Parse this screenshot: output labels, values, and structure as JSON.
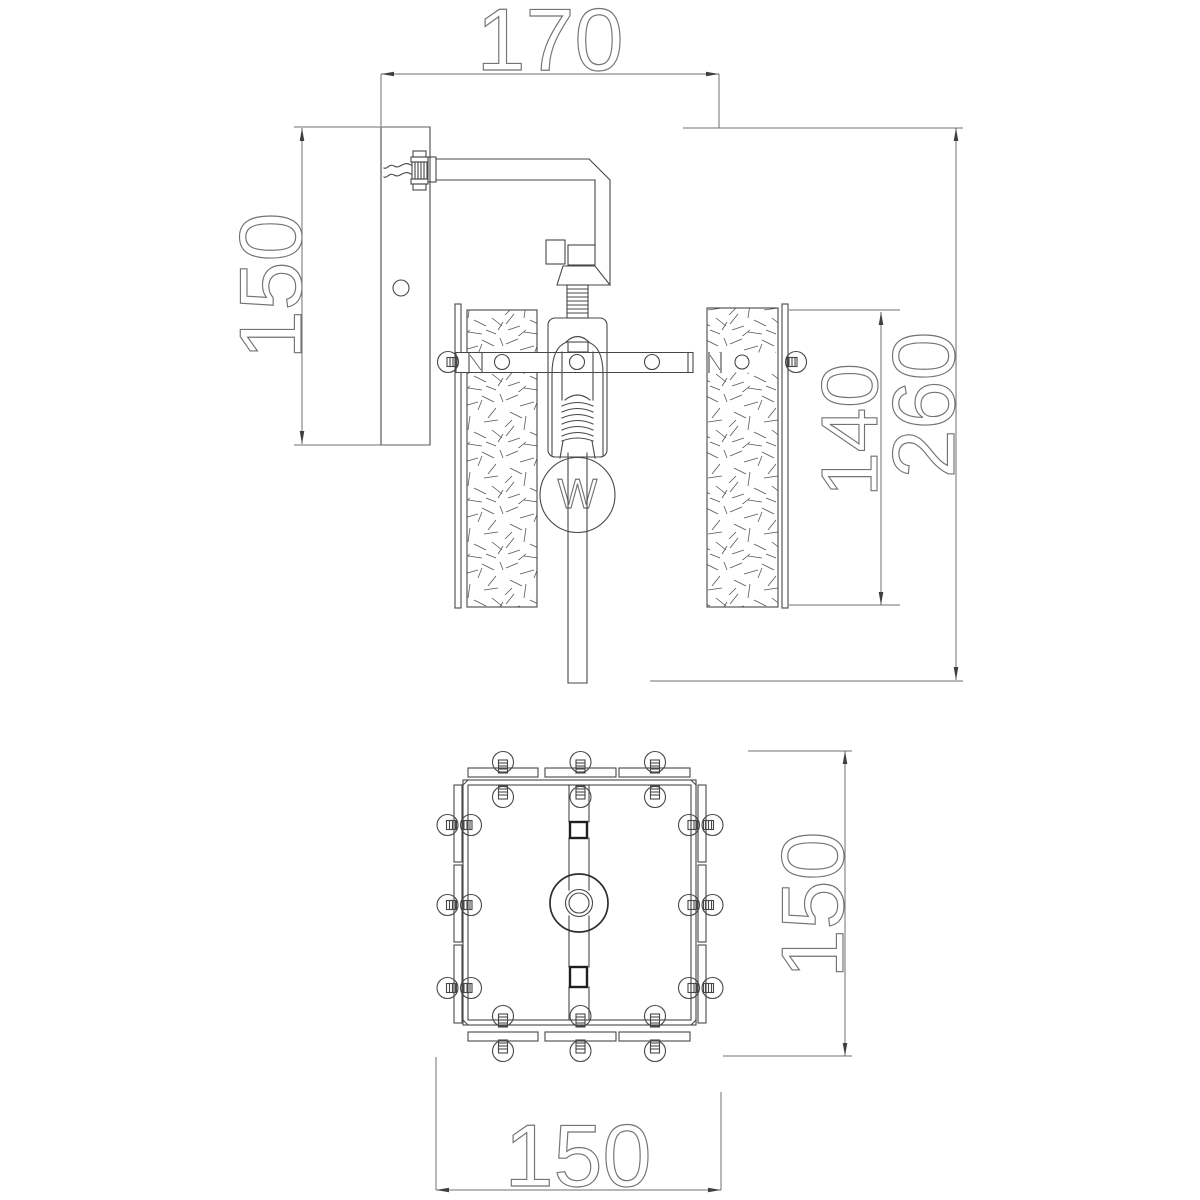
{
  "page": {
    "background": "#ffffff",
    "drawing_type": "wall-lamp technical drawing",
    "line_color": "#474747",
    "dimension_color": "#6f6f6f",
    "text_outline_color": "#737373"
  },
  "front_view": {
    "name": "side-elevation",
    "dimensions": {
      "depth": "170",
      "backplate_height": "150",
      "shade_height": "140",
      "overall_height": "260"
    },
    "bulb_label": "W"
  },
  "plan_view": {
    "name": "top-plan",
    "dimensions": {
      "width": "150",
      "depth": "150"
    }
  }
}
